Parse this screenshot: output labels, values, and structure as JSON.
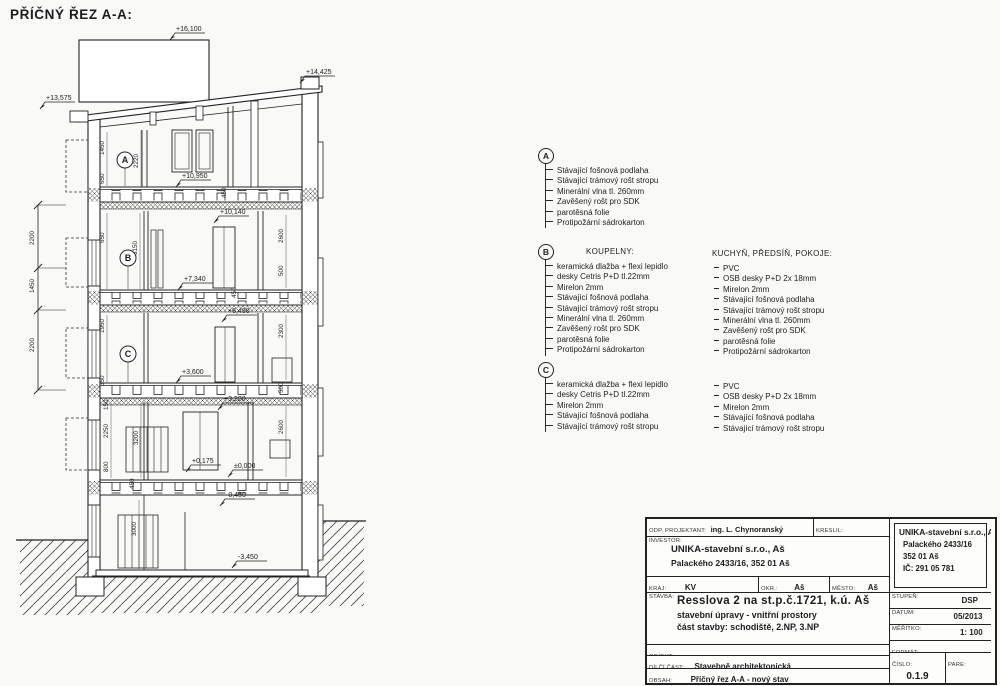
{
  "page": {
    "title": "PŘÍČNÝ ŘEZ A-A:"
  },
  "drawing": {
    "elevations": [
      {
        "label": "+16,100",
        "x": 176,
        "y": 31
      },
      {
        "label": "+14,425",
        "x": 306,
        "y": 74
      },
      {
        "label": "+13,575",
        "x": 46,
        "y": 100
      },
      {
        "label": "+10,950",
        "x": 182,
        "y": 178
      },
      {
        "label": "+10,140",
        "x": 220,
        "y": 214
      },
      {
        "label": "+7,340",
        "x": 184,
        "y": 281
      },
      {
        "label": "+6,490",
        "x": 228,
        "y": 313
      },
      {
        "label": "+3,600",
        "x": 182,
        "y": 374
      },
      {
        "label": "+3,200",
        "x": 224,
        "y": 401
      },
      {
        "label": "+0,175",
        "x": 192,
        "y": 463
      },
      {
        "label": "±0,000",
        "x": 234,
        "y": 468
      },
      {
        "label": "-0,450",
        "x": 226,
        "y": 497
      },
      {
        "label": "-3,450",
        "x": 238,
        "y": 559
      }
    ],
    "dims": [
      {
        "label": "2200",
        "x": 34,
        "y": 245
      },
      {
        "label": "1450",
        "x": 34,
        "y": 293
      },
      {
        "label": "2200",
        "x": 34,
        "y": 352
      },
      {
        "label": "1450",
        "x": 104,
        "y": 155
      },
      {
        "label": "650",
        "x": 104,
        "y": 184
      },
      {
        "label": "2220",
        "x": 138,
        "y": 168
      },
      {
        "label": "450",
        "x": 226,
        "y": 198
      },
      {
        "label": "650",
        "x": 104,
        "y": 243
      },
      {
        "label": "3150",
        "x": 137,
        "y": 255
      },
      {
        "label": "2600",
        "x": 283,
        "y": 243
      },
      {
        "label": "500",
        "x": 283,
        "y": 276
      },
      {
        "label": "1950",
        "x": 104,
        "y": 333
      },
      {
        "label": "350",
        "x": 104,
        "y": 386
      },
      {
        "label": "450",
        "x": 236,
        "y": 298
      },
      {
        "label": "2300",
        "x": 283,
        "y": 338
      },
      {
        "label": "500",
        "x": 283,
        "y": 393
      },
      {
        "label": "150",
        "x": 108,
        "y": 410
      },
      {
        "label": "2250",
        "x": 108,
        "y": 438
      },
      {
        "label": "800",
        "x": 108,
        "y": 472
      },
      {
        "label": "3200",
        "x": 138,
        "y": 445
      },
      {
        "label": "2600",
        "x": 283,
        "y": 434
      },
      {
        "label": "450",
        "x": 134,
        "y": 489
      },
      {
        "label": "3000",
        "x": 136,
        "y": 536
      }
    ],
    "markers": [
      {
        "label": "A",
        "x": 125,
        "y": 160,
        "ly": 186
      },
      {
        "label": "B",
        "x": 128,
        "y": 258,
        "ly": 289
      },
      {
        "label": "C",
        "x": 128,
        "y": 354,
        "ly": 382
      }
    ]
  },
  "legend": {
    "a": {
      "marker": "A",
      "items": [
        "Stávající fošnová podlaha",
        "Stávající trámový rošt stropu",
        "Minerální vlna tl. 260mm",
        "Zavěšený rošt pro SDK",
        "parotěsná folie",
        "Protipožární sádrokarton"
      ]
    },
    "b": {
      "marker": "B",
      "left_title": "KOUPELNY:",
      "left_items": [
        "keramická dlažba + flexi lepidlo",
        "desky Cetris P+D tl.22mm",
        "Mirelon 2mm",
        "Stávající fošnová podlaha",
        "Stávající trámový rošt stropu",
        "Minerální vlna tl. 260mm",
        "Zavěšený rošt pro SDK",
        "parotěsná folie",
        "Protipožární sádrokarton"
      ],
      "right_title": "KUCHYŇ, PŘEDSÍŇ, POKOJE:",
      "right_items": [
        "PVC",
        "OSB desky P+D 2x 18mm",
        "Mirelon 2mm",
        "Stávající fošnová podlaha",
        "Stávající trámový rošt stropu",
        "Minerální vlna tl. 260mm",
        "Zavěšený rošt pro SDK",
        "parotěsná folie",
        "Protipožární sádrokarton"
      ]
    },
    "c": {
      "marker": "C",
      "left_items": [
        "keramická dlažba + flexi lepidlo",
        "desky Cetris P+D tl.22mm",
        "Mirelon 2mm",
        "Stávající fošnová podlaha",
        "Stávající trámový rošt stropu"
      ],
      "right_items": [
        "PVC",
        "OSB desky P+D 2x 18mm",
        "Mirelon 2mm",
        "Stávající fošnová podlaha",
        "Stávající trámový rošt stropu"
      ]
    }
  },
  "titleblock": {
    "proj_label": "ODP. PROJEKTANT:",
    "proj_value": "ing. L. Chynoranský (č.a.:0009070)",
    "kreslil_label": "KRESLIL:",
    "kreslil_value": "Chynoranský",
    "investor_label": "INVESTOR:",
    "investor_line1": "UNIKA-stavební s.r.o., Aš",
    "investor_line2": "Palackého 2433/16, 352 01 Aš",
    "kraj_label": "KRAJ:",
    "kraj_value": "KV",
    "okres_label": "OKR.:",
    "okres_value": "Aš",
    "mesto_label": "MĚSTO:",
    "mesto_value": "Aš",
    "stavba_label": "STAVBA:",
    "stavba_line1": "Resslova 2 na st.p.č.1721, k.ú. Aš",
    "stavba_line2": "stavební úpravy - vnitřní prostory",
    "stavba_line3": "část stavby: schodiště, 2.NP, 3.NP",
    "objekt_label": "OBJEKT:",
    "dilci_label": "DÍLČÍ ČÁST:",
    "dilci_value": "Stavebně architektonická",
    "obsah_label": "OBSAH:",
    "obsah_value": "Příčný řez A-A - nový stav",
    "firm": {
      "name": "UNIKA-stavební s.r.o., Aš",
      "addr1": "Palackého 2433/16",
      "addr2": "352 01 Aš",
      "ic": "IČ: 291 05 781"
    },
    "stupen_label": "STUPEŇ:",
    "stupen_value": "DSP",
    "datum_label": "DATUM:",
    "datum_value": "05/2013",
    "meritko_label": "MĚŘÍTKO:",
    "meritko_value": "1: 100",
    "format_label": "FORMÁT:",
    "cislo_label": "ČÍSLO:",
    "cislo_value": "0.1.9",
    "pare_label": "PARE:"
  }
}
